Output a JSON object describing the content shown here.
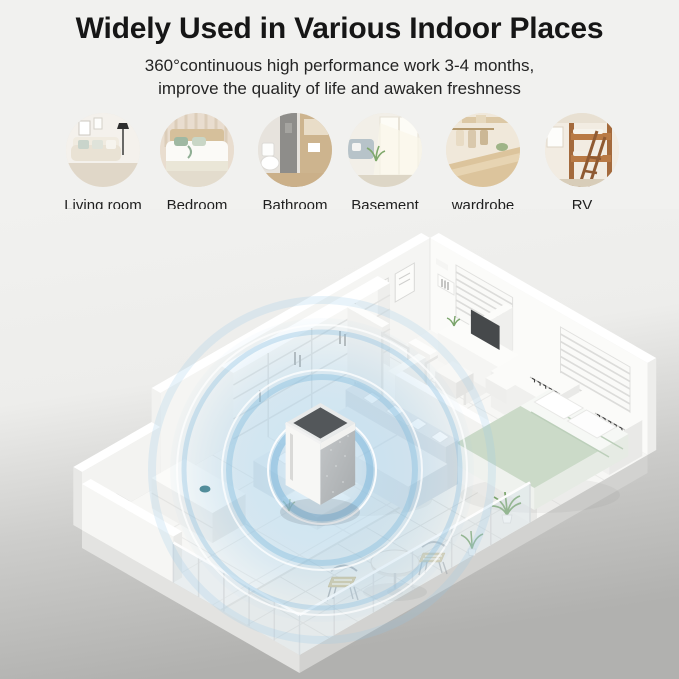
{
  "header": {
    "title": "Widely Used in Various Indoor Places",
    "subtitle_line1": "360°continuous high performance work 3-4 months,",
    "subtitle_line2": "improve the quality of life and awaken freshness"
  },
  "places": [
    {
      "label": "Living room"
    },
    {
      "label": "Bedroom"
    },
    {
      "label": "Bathroom"
    },
    {
      "label": "Basement"
    },
    {
      "label": "wardrobe"
    },
    {
      "label": "RV"
    }
  ],
  "floorplan": {
    "type": "isometric apartment cutaway",
    "product": "air purifier with 360° coverage ripples",
    "colors": {
      "ripple_blue": "#a9d3ea",
      "wall_white": "#fafaf8",
      "floor_white": "#f7f7f5",
      "outside_gray": "#b3b3b1",
      "bed_green": "#cbdac8"
    }
  }
}
